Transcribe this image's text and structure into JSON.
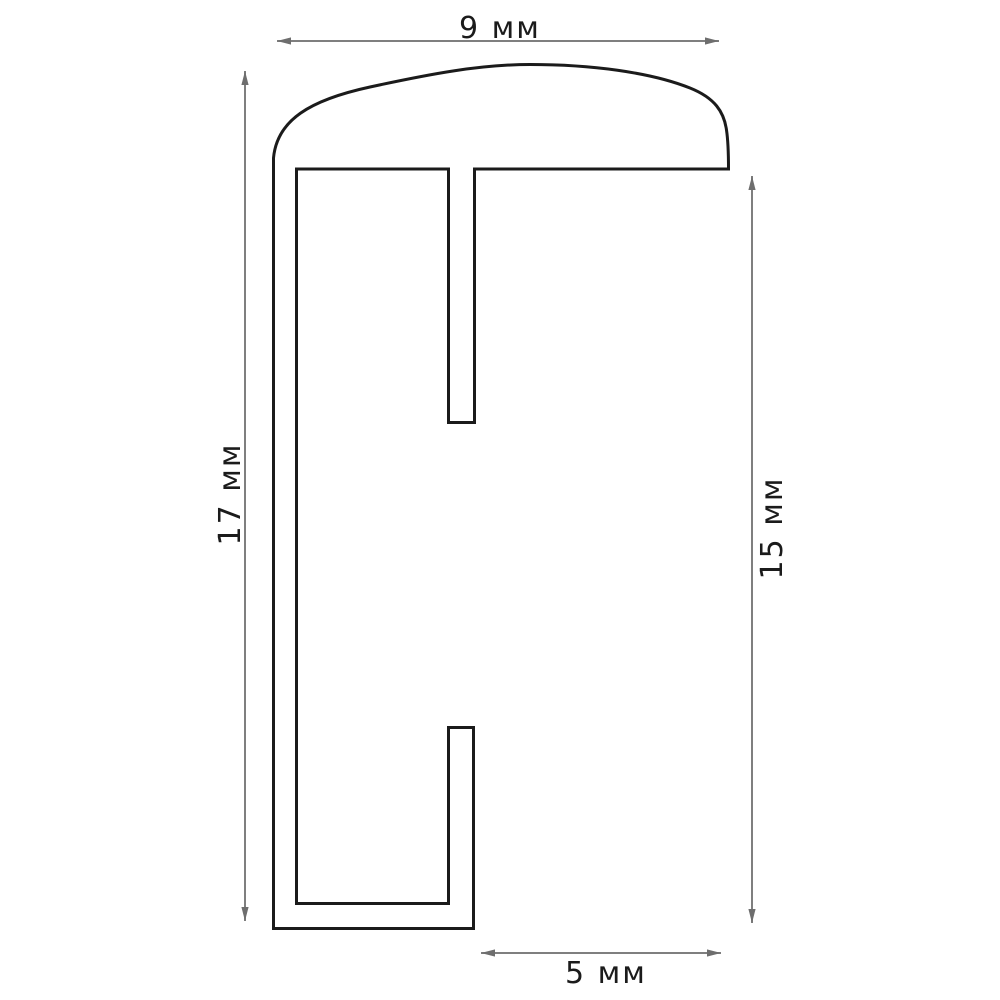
{
  "drawing": {
    "type": "technical-profile-cross-section",
    "unit": "мм",
    "dimensions": {
      "top": {
        "label": "9 мм",
        "value": 9,
        "orientation": "horizontal",
        "side": "top"
      },
      "left": {
        "label": "17 мм",
        "value": 17,
        "orientation": "vertical",
        "side": "left"
      },
      "right": {
        "label": "15 мм",
        "value": 15,
        "orientation": "vertical",
        "side": "right"
      },
      "bottom": {
        "label": "5 мм",
        "value": 5,
        "orientation": "horizontal",
        "side": "bottom"
      }
    },
    "colors": {
      "background": "#ffffff",
      "profile_outline": "#1b1b1b",
      "dimension_line": "#7f7f7f",
      "arrowhead": "#6e6e6e",
      "label_text": "#1b1b1b"
    },
    "icons": {
      "arrowheads": "dimension-arrowhead-icon"
    }
  }
}
